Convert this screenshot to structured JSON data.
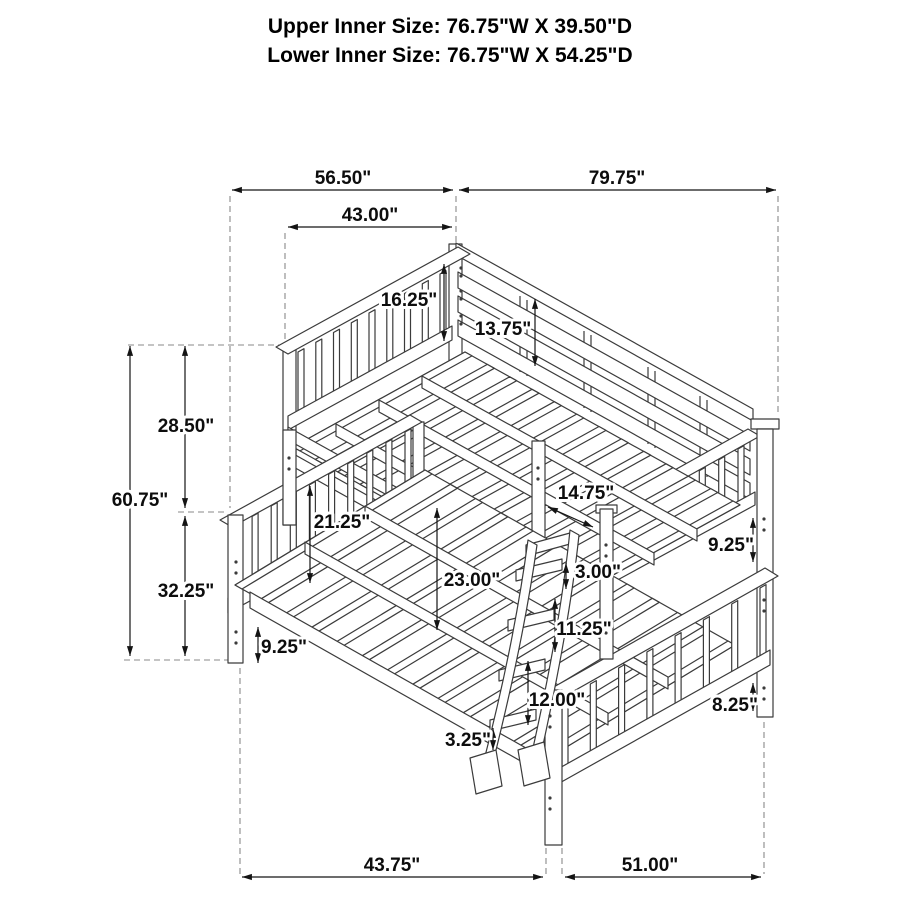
{
  "title": {
    "line1": "Upper Inner Size: 76.75\"W X 39.50\"D",
    "line2": "Lower Inner Size: 76.75\"W X 54.25\"D"
  },
  "dims": {
    "top_overall_width": "56.50\"",
    "top_overall_length": "79.75\"",
    "upper_headboard_width": "43.00\"",
    "upper_guardrail_height": "16.25\"",
    "upper_rail_to_deck": "13.75\"",
    "upper_section_height": "28.50\"",
    "overall_height": "60.75\"",
    "lower_section_height": "32.25\"",
    "lower_headboard_to_deck": "21.25\"",
    "bunk_clearance": "23.00\"",
    "front_width_offset": "14.75\"",
    "ladder_top_gap": "3.00\"",
    "right_guard_gap": "9.25\"",
    "ladder_rung_spacing": "11.25\"",
    "left_rail_to_floor": "9.25\"",
    "ladder_bottom_to_floor": "12.00\"",
    "right_rail_to_floor": "8.25\"",
    "ladder_foot_height": "3.25\"",
    "bottom_lower_width": "43.75\"",
    "bottom_lower_length": "51.00\""
  },
  "colors": {
    "line": "#3b3b3b",
    "dimension": "#141414",
    "extension": "#8a8a8a",
    "text": "#0d0d0d",
    "background": "#ffffff"
  }
}
